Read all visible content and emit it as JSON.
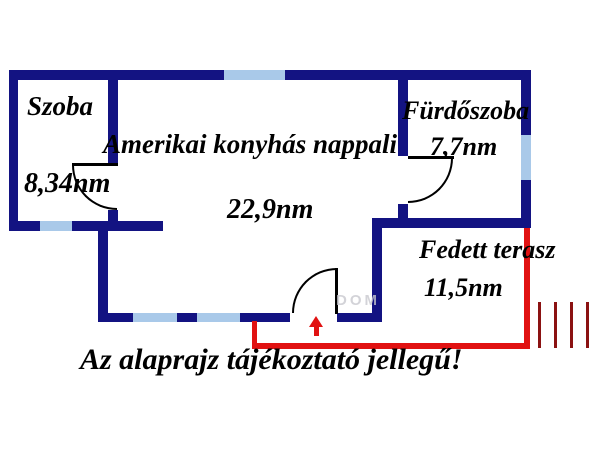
{
  "floorplan": {
    "rooms": [
      {
        "label": "Szoba",
        "area": "8,34nm"
      },
      {
        "label": "Amerikai konyhás nappali",
        "area": "22,9nm"
      },
      {
        "label": "Fürdőszoba",
        "area": "7,7nm"
      },
      {
        "label": "Fedett terasz",
        "area": "11,5nm"
      }
    ],
    "disclaimer": "Az alaprajz tájékoztató jellegű!",
    "watermark": "DOM",
    "colors": {
      "wall": "#131382",
      "window": "#a9c9e9",
      "terrace_outline": "#e11212",
      "hatch_lines": "#8b1212",
      "entry_arrow": "#e11212",
      "text": "#000000"
    }
  }
}
